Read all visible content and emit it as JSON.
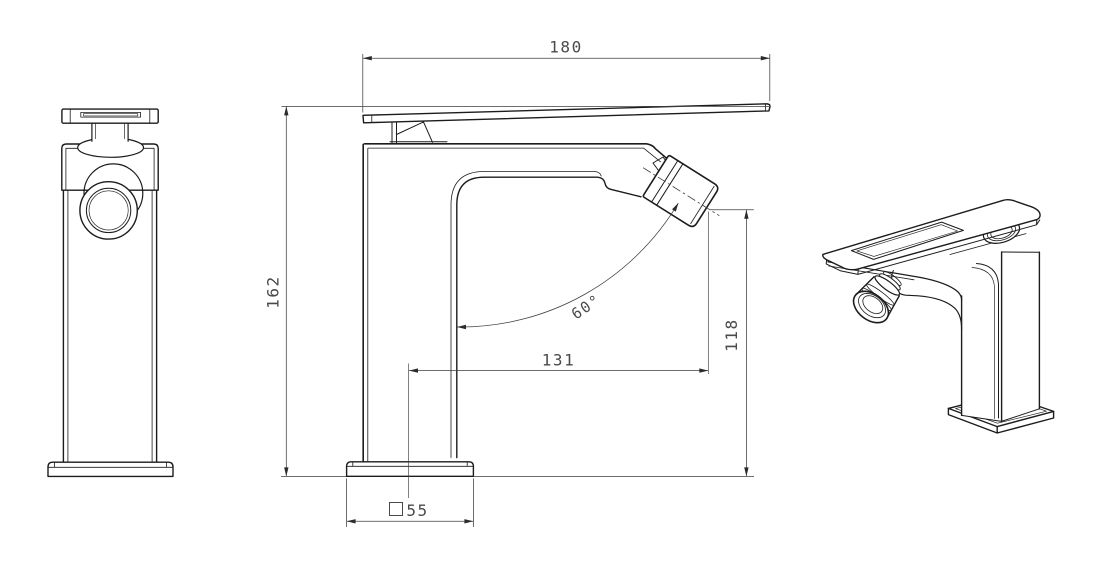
{
  "dims": {
    "handle_length": "180",
    "overall_height": "162",
    "spout_reach": "131",
    "outlet_height": "118",
    "swivel_angle": "60°",
    "base_square": "55"
  },
  "colors": {
    "background": "#ffffff",
    "outline": "#1c1c1c",
    "dimension_lines": "#3f3f3f",
    "dimension_text": "#4a4a4a"
  }
}
